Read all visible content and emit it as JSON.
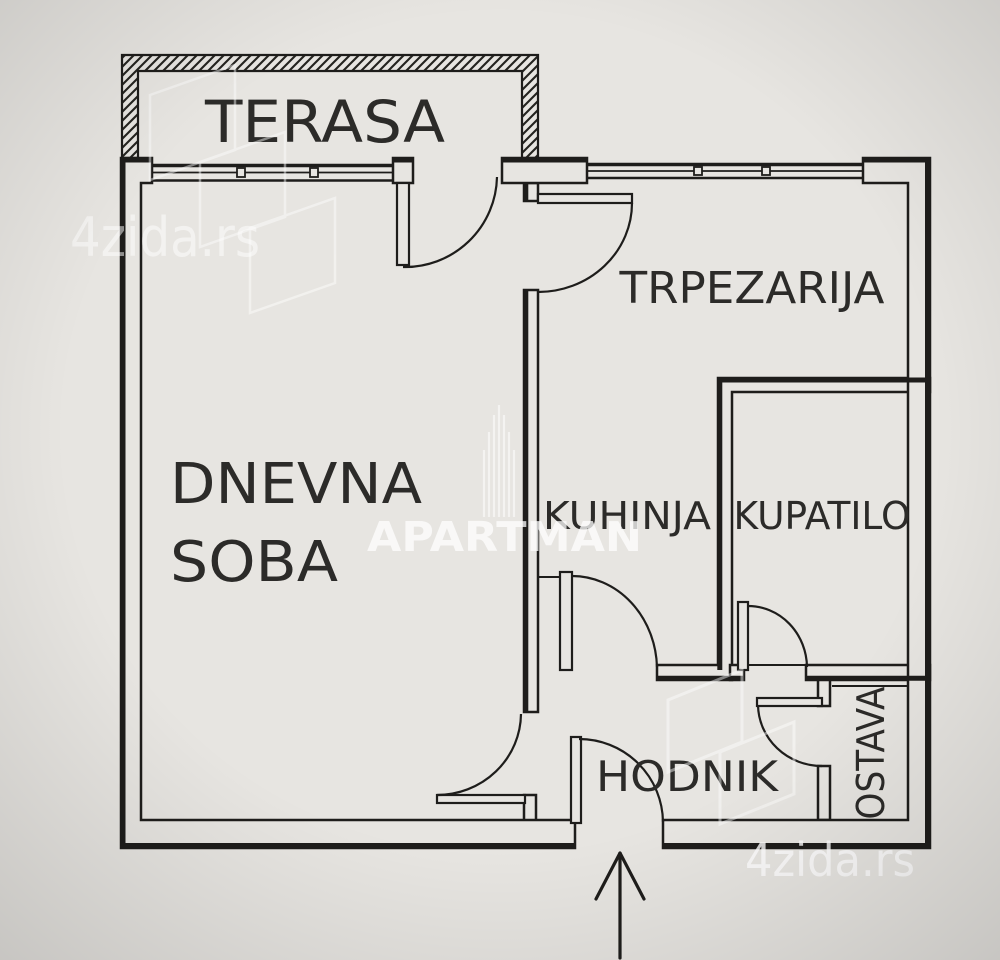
{
  "plan": {
    "rooms": {
      "terasa": "TERASA",
      "trpezarija": "TRPEZARIJA",
      "dnevna_soba_line1": "DNEVNA",
      "dnevna_soba_line2": "SOBA",
      "kuhinja": "KUHINJA",
      "kupatilo": "KUPATILO",
      "hodnik": "HODNIK",
      "ostava": "OSTAVA"
    },
    "watermarks": {
      "brand_top_left": "4zida.rs",
      "brand_bottom_right": "4zida.rs",
      "agency": "APARTMAN"
    },
    "colors": {
      "background": "#e7e5e1",
      "wall_line": "#1e1d1b",
      "label_text": "#2c2b29",
      "watermark_white": "#ffffff"
    },
    "icons": {
      "entrance_arrow": "entrance-arrow-icon",
      "brand_logo": "brand-3d-walls-logo-icon",
      "agency_logo": "monument-logo-icon"
    }
  }
}
